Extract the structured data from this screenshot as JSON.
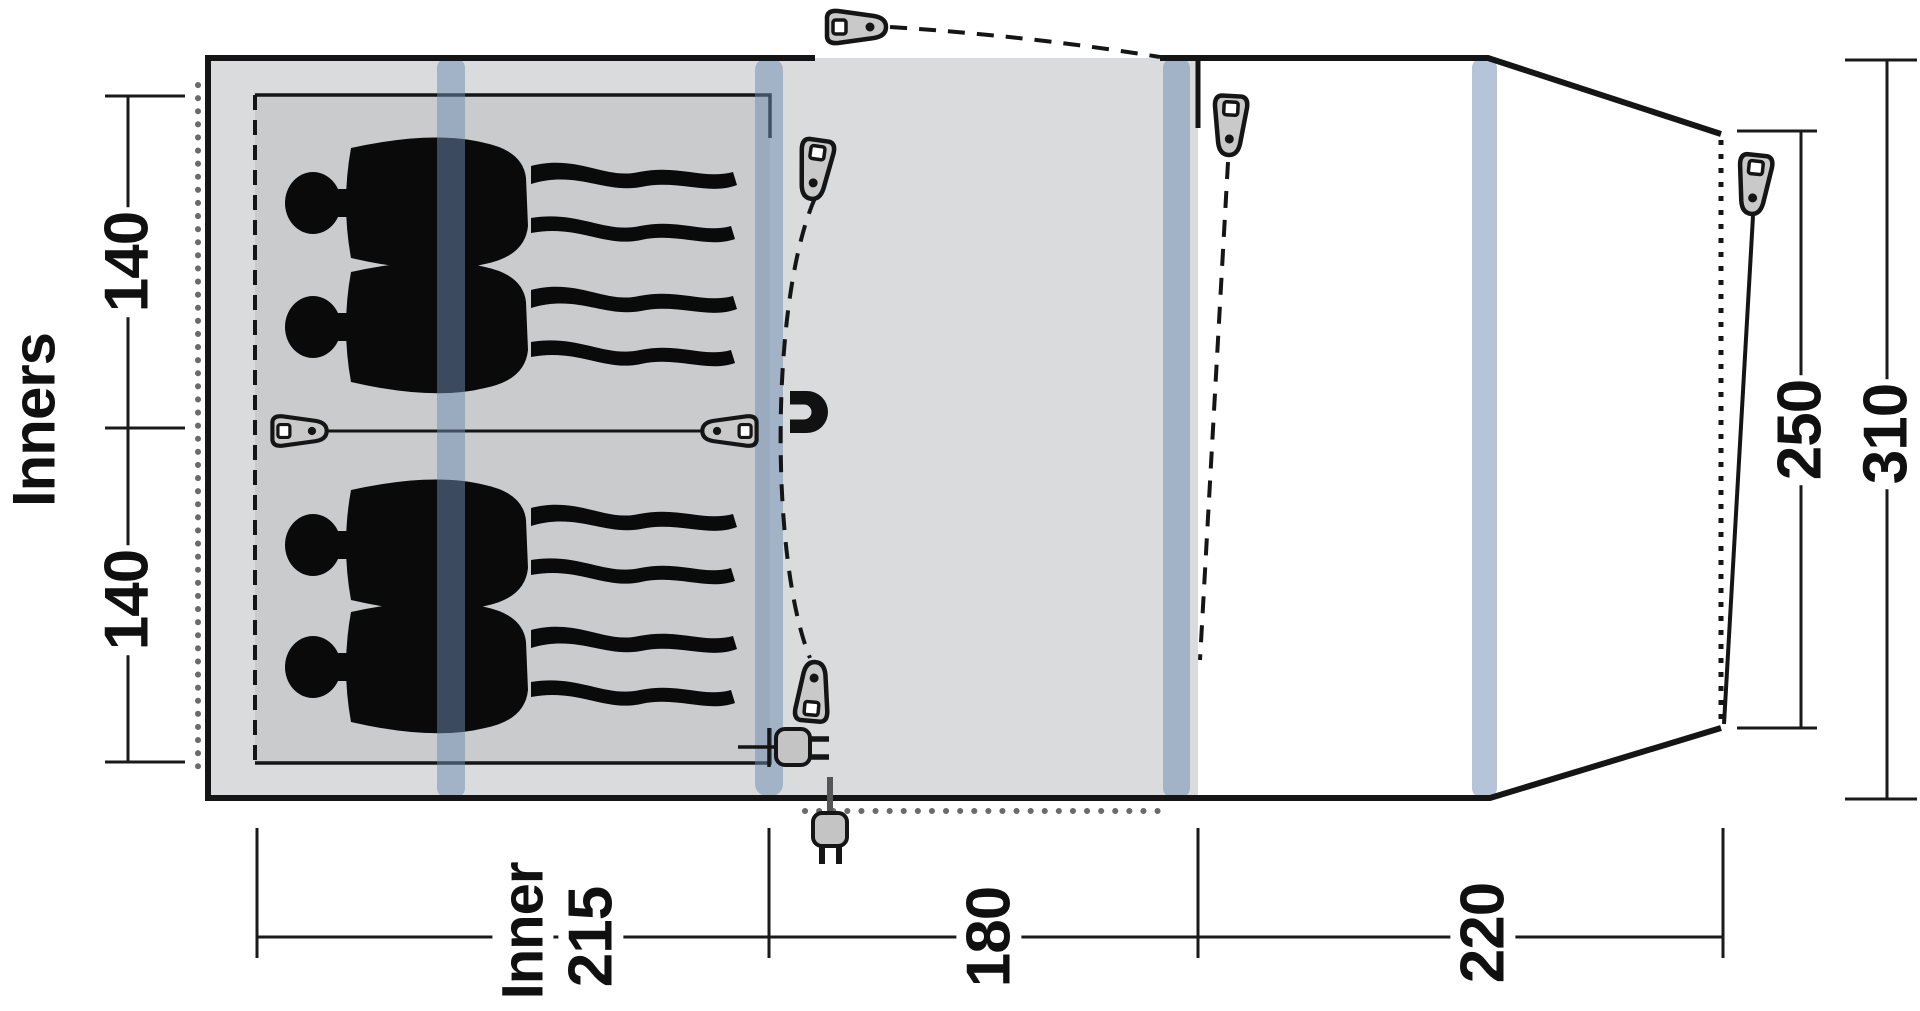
{
  "diagram": {
    "type": "tent-floorplan",
    "description": "Top view floor plan of a family tent with inner sleeping cabin for four, middle room and front section",
    "labels": {
      "side": "Inners",
      "seg1": "140",
      "seg2": "140",
      "inner_word": "Inner",
      "inner_len": "215",
      "mid_len": "180",
      "front_len": "220",
      "door_width": "250",
      "total_width": "310"
    },
    "icons": [
      "zipper-toggle-icon",
      "magnet-icon",
      "power-plug-icon",
      "person-silhouette",
      "tent-pole-stripe"
    ],
    "colors": {
      "canvas": "#ffffff",
      "fabric_gray": "#d9dbdc",
      "inner_gray": "#c9cbcc",
      "pole_blue": "rgba(108,138,177,0.5)",
      "outline_black": "#151515",
      "silhouette_black": "#0a0a0a",
      "toggle_gray": "#c9c9c9"
    }
  },
  "dimensions": {
    "unit": "cm (implied)",
    "inner_cabin_berth_widths": [
      140,
      140
    ],
    "inner_cabin_depth": 215,
    "middle_room_depth": 180,
    "front_room_depth": 220,
    "front_opening_width": 250,
    "total_width": 310,
    "sleeping_capacity": 4
  }
}
